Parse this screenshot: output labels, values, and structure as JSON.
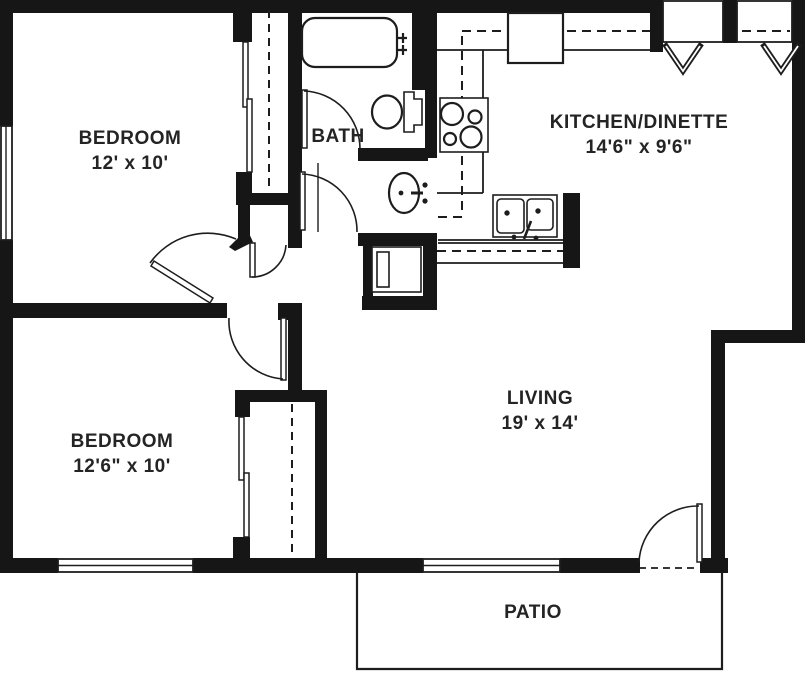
{
  "document": {
    "type": "apartment floor plan"
  },
  "colors": {
    "wall": "#161616",
    "ink": "#1d1d1d",
    "text": "#242424",
    "background": "#ffffff"
  },
  "rooms": {
    "bedroom_top": {
      "label": "BEDROOM",
      "dims": "12' x 10'"
    },
    "bedroom_bottom": {
      "label": "BEDROOM",
      "dims": "12'6\" x 10'"
    },
    "bath": {
      "label": "BATH"
    },
    "kitchen": {
      "label": "KITCHEN/DINETTE",
      "dims": "14'6\" x 9'6\""
    },
    "living": {
      "label": "LIVING",
      "dims": "19' x 14'"
    },
    "patio": {
      "label": "PATIO"
    }
  }
}
